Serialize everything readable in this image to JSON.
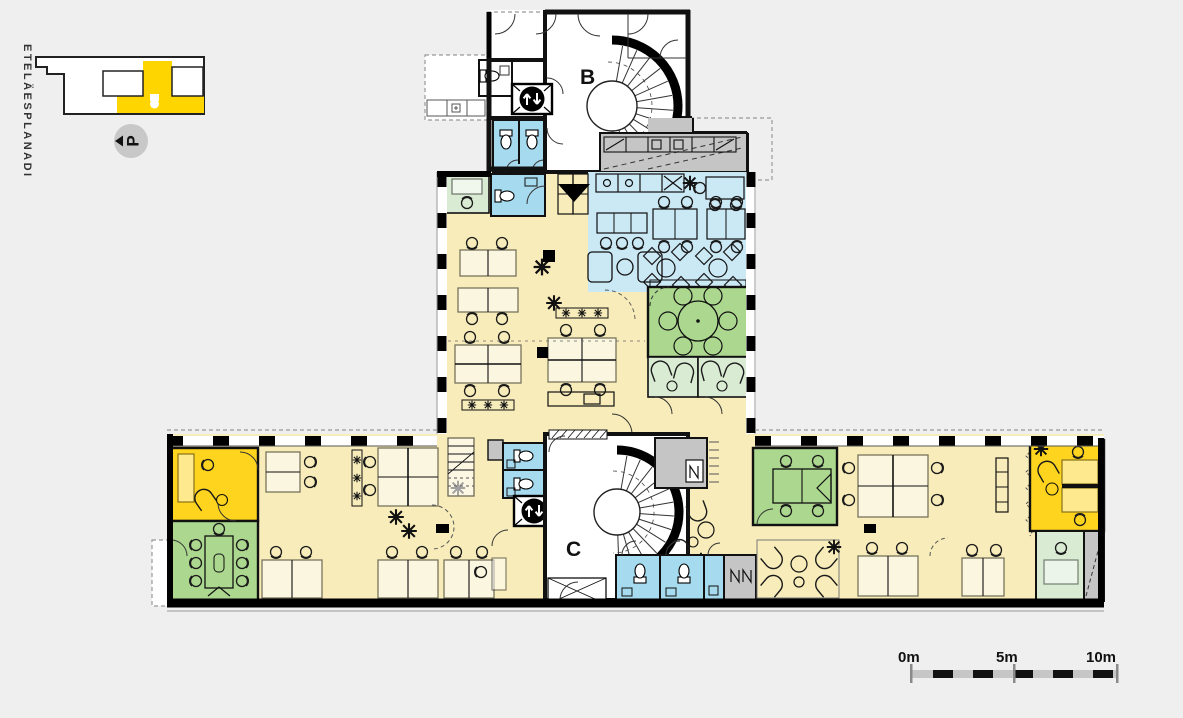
{
  "canvas": {
    "width": 1183,
    "height": 718,
    "background": "#EFEFEF"
  },
  "key_plan": {
    "street_label": "ETELÄESPLANADI",
    "parking_label": "P",
    "highlight_color": "#FFD500"
  },
  "floor_plan": {
    "stairwell_b_label": "B",
    "stairwell_c_label": "C"
  },
  "scale_bar": {
    "tick_0": "0m",
    "tick_5": "5m",
    "tick_10": "10m"
  },
  "colors": {
    "background": "#EFEFEF",
    "wall": "#111111",
    "floor_white": "#FFFFFF",
    "open_office_yellow": "#F8EDBA",
    "accent_yellow": "#FFD41E",
    "dining_blue": "#CBE8F5",
    "wc_blue": "#A6DAEF",
    "meeting_green": "#ABD78F",
    "lounge_green": "#DAEBD4",
    "service_gray": "#C5C5C5"
  },
  "icons": {
    "elevator": "up-down-arrows",
    "parking_direction": "left-triangle",
    "entrance": "down-triangle"
  }
}
